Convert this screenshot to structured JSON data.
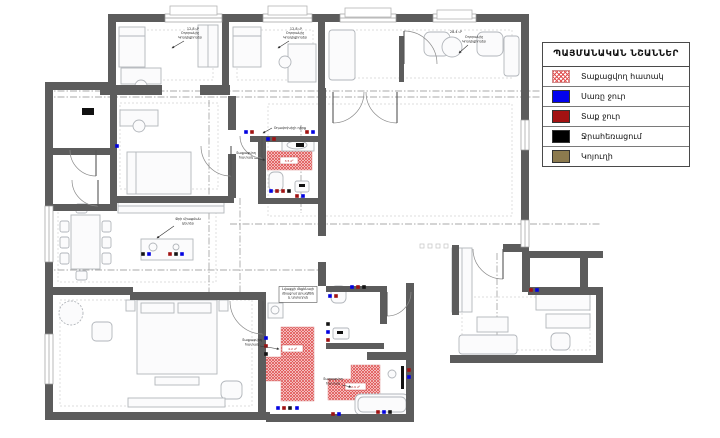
{
  "legend": {
    "title": "ՊԱՅՄԱՆԱԿԱՆ ՆՇԱՆՆԵՐ",
    "items": [
      {
        "swatch": "hatch",
        "label": "Տաքացվող հատակ"
      },
      {
        "swatch": "#0202ee",
        "label": "Սառը ջուր"
      },
      {
        "swatch": "#a31212",
        "label": "Տաք ջուր"
      },
      {
        "swatch": "#000000",
        "label": "Ջրահեռացում"
      },
      {
        "swatch": "#8c7a4e",
        "label": "Կոյուղի"
      }
    ]
  },
  "floorplan": {
    "wall_color": "#5c5c5c",
    "hatch_color": "#e05252",
    "marker_colors": {
      "c": "#0202e0",
      "h": "#a01212",
      "d": "#141414"
    },
    "walls": [
      [
        108,
        14,
        421,
        8
      ],
      [
        108,
        14,
        8,
        74
      ],
      [
        45,
        82,
        71,
        8
      ],
      [
        45,
        82,
        8,
        338
      ],
      [
        45,
        412,
        225,
        8
      ],
      [
        266,
        414,
        148,
        8
      ],
      [
        406,
        283,
        8,
        139
      ],
      [
        367,
        352,
        47,
        8
      ],
      [
        450,
        355,
        153,
        8
      ],
      [
        596,
        287,
        7,
        76
      ],
      [
        528,
        287,
        75,
        8
      ],
      [
        528,
        251,
        75,
        7
      ],
      [
        580,
        251,
        8,
        42
      ],
      [
        521,
        22,
        8,
        225
      ],
      [
        503,
        244,
        26,
        8
      ],
      [
        522,
        252,
        8,
        40
      ],
      [
        318,
        22,
        7,
        66
      ],
      [
        222,
        22,
        7,
        66
      ],
      [
        200,
        85,
        30,
        10
      ],
      [
        100,
        85,
        62,
        10
      ],
      [
        228,
        96,
        8,
        34
      ],
      [
        228,
        154,
        8,
        44
      ],
      [
        250,
        136,
        76,
        6
      ],
      [
        258,
        136,
        8,
        64
      ],
      [
        258,
        198,
        68,
        6
      ],
      [
        318,
        88,
        8,
        118
      ],
      [
        318,
        206,
        8,
        30
      ],
      [
        318,
        262,
        8,
        24
      ],
      [
        110,
        88,
        7,
        123
      ],
      [
        53,
        148,
        63,
        7
      ],
      [
        53,
        204,
        63,
        7
      ],
      [
        116,
        196,
        118,
        7
      ],
      [
        53,
        287,
        80,
        8
      ],
      [
        130,
        292,
        136,
        8
      ],
      [
        258,
        292,
        8,
        128
      ],
      [
        326,
        286,
        56,
        6
      ],
      [
        380,
        286,
        7,
        38
      ],
      [
        326,
        343,
        58,
        6
      ],
      [
        399,
        36,
        5,
        46
      ],
      [
        452,
        245,
        7,
        70
      ]
    ],
    "windows_h": [
      [
        165,
        14,
        57,
        8
      ],
      [
        263,
        14,
        49,
        8
      ],
      [
        340,
        14,
        56,
        8
      ],
      [
        433,
        14,
        43,
        8
      ]
    ],
    "windows_v": [
      [
        45,
        206,
        8,
        56
      ],
      [
        45,
        334,
        8,
        50
      ],
      [
        521,
        120,
        8,
        30
      ],
      [
        521,
        220,
        8,
        27
      ]
    ],
    "sills": [
      [
        170,
        6,
        47,
        9
      ],
      [
        268,
        6,
        39,
        9
      ],
      [
        345,
        8,
        46,
        9
      ],
      [
        437,
        10,
        35,
        9
      ]
    ],
    "dash_rects": [
      [
        123,
        30,
        90,
        50
      ],
      [
        237,
        30,
        76,
        50
      ],
      [
        332,
        30,
        180,
        48
      ],
      [
        268,
        104,
        244,
        112
      ],
      [
        120,
        103,
        98,
        86
      ],
      [
        60,
        300,
        192,
        106
      ],
      [
        462,
        297,
        128,
        53
      ],
      [
        58,
        206,
        158,
        76
      ]
    ],
    "axes": [
      [
        45,
        91,
        540,
        91
      ],
      [
        45,
        97,
        540,
        97
      ],
      [
        230,
        224,
        600,
        224
      ],
      [
        45,
        270,
        320,
        270
      ],
      [
        209,
        100,
        209,
        298
      ],
      [
        301,
        125,
        301,
        213
      ],
      [
        240,
        198,
        240,
        294
      ],
      [
        497,
        253,
        497,
        353
      ]
    ],
    "furniture": [
      [
        "rect",
        119,
        27,
        26,
        40
      ],
      [
        "line",
        119,
        36,
        145,
        36
      ],
      [
        "rect",
        121,
        68,
        40,
        16
      ],
      [
        "circle",
        141,
        86,
        6
      ],
      [
        "rect",
        198,
        25,
        20,
        42
      ],
      [
        "line",
        208,
        25,
        208,
        67
      ],
      [
        "rect",
        233,
        27,
        28,
        40
      ],
      [
        "line",
        233,
        36,
        261,
        36
      ],
      [
        "rect",
        288,
        44,
        28,
        38
      ],
      [
        "circle",
        285,
        62,
        6
      ],
      [
        "rect",
        329,
        30,
        26,
        50,
        3
      ],
      [
        "rect",
        424,
        32,
        26,
        24,
        6
      ],
      [
        "rect",
        477,
        32,
        26,
        24,
        6
      ],
      [
        "circle",
        452,
        47,
        10
      ],
      [
        "rect",
        504,
        36,
        15,
        40,
        3
      ],
      [
        "rect",
        120,
        110,
        38,
        16
      ],
      [
        "circle",
        139,
        126,
        6
      ],
      [
        "rect",
        127,
        152,
        64,
        42
      ],
      [
        "line",
        136,
        152,
        136,
        194
      ],
      [
        "rect",
        118,
        200,
        106,
        13
      ],
      [
        "line",
        118,
        206,
        224,
        206
      ],
      [
        "rect",
        141,
        239,
        52,
        21
      ],
      [
        "circle",
        153,
        247,
        4
      ],
      [
        "circle",
        176,
        247,
        3
      ],
      [
        "rect",
        71,
        215,
        29,
        54
      ],
      [
        "rect",
        60,
        221,
        9,
        11,
        2
      ],
      [
        "rect",
        60,
        237,
        9,
        11,
        2
      ],
      [
        "rect",
        60,
        253,
        9,
        11,
        2
      ],
      [
        "rect",
        102,
        221,
        9,
        11,
        2
      ],
      [
        "rect",
        102,
        237,
        9,
        11,
        2
      ],
      [
        "rect",
        102,
        253,
        9,
        11,
        2
      ],
      [
        "rect",
        76,
        204,
        11,
        9,
        2
      ],
      [
        "rect",
        76,
        271,
        11,
        9,
        2
      ],
      [
        "rect",
        137,
        300,
        80,
        74
      ],
      [
        "rect",
        141,
        303,
        33,
        10
      ],
      [
        "rect",
        178,
        303,
        33,
        10
      ],
      [
        "rect",
        126,
        300,
        9,
        11
      ],
      [
        "rect",
        219,
        300,
        9,
        11
      ],
      [
        "rect",
        155,
        377,
        44,
        8
      ],
      [
        "dcircle",
        71,
        313,
        12
      ],
      [
        "rect",
        92,
        322,
        20,
        19,
        4
      ],
      [
        "rect",
        221,
        381,
        21,
        18,
        5
      ],
      [
        "rect",
        128,
        398,
        97,
        9
      ],
      [
        "rect",
        459,
        335,
        58,
        19,
        3
      ],
      [
        "rect",
        477,
        317,
        31,
        15
      ],
      [
        "rect",
        546,
        314,
        44,
        14
      ],
      [
        "rect",
        551,
        333,
        19,
        17,
        5
      ],
      [
        "rect",
        536,
        293,
        54,
        17
      ],
      [
        "rect",
        452,
        248,
        20,
        64
      ],
      [
        "line",
        462,
        248,
        462,
        312
      ],
      [
        "rect",
        282,
        139,
        32,
        12
      ],
      [
        "ellipse",
        297,
        145,
        10,
        4
      ],
      [
        "rect",
        269,
        172,
        14,
        19,
        5
      ],
      [
        "rect",
        295,
        181,
        14,
        11,
        2
      ],
      [
        "rect",
        331,
        286,
        15,
        17,
        5
      ],
      [
        "rect",
        333,
        328,
        16,
        11,
        2
      ],
      [
        "rect",
        268,
        303,
        15,
        15
      ],
      [
        "circle",
        275,
        310,
        4
      ],
      [
        "rect",
        355,
        394,
        54,
        21,
        6
      ],
      [
        "rect",
        358,
        397,
        48,
        15,
        5
      ],
      [
        "circle",
        392,
        374,
        4
      ]
    ],
    "black_items": [
      [
        82,
        108,
        12,
        7
      ],
      [
        296,
        143,
        8,
        4
      ],
      [
        299,
        184,
        6,
        3
      ],
      [
        337,
        331,
        6,
        3
      ],
      [
        401,
        366,
        3,
        23
      ]
    ],
    "heated_areas": [
      [
        267,
        151,
        45,
        19
      ],
      [
        281,
        327,
        33,
        31
      ],
      [
        263,
        357,
        51,
        24
      ],
      [
        281,
        380,
        33,
        21
      ],
      [
        328,
        379,
        52,
        21
      ],
      [
        351,
        365,
        29,
        15
      ]
    ],
    "area_chips": [
      {
        "x": 280,
        "y": 157,
        "w": 18,
        "h": 7,
        "label": "3.5 մ²"
      },
      {
        "x": 282,
        "y": 345,
        "w": 21,
        "h": 7,
        "label": "4.2 մ²"
      },
      {
        "x": 345,
        "y": 383,
        "w": 21,
        "h": 7,
        "label": "2.9 մ²"
      }
    ],
    "markers": [
      [
        143,
        254,
        "d"
      ],
      [
        149,
        254,
        "c"
      ],
      [
        170,
        254,
        "h"
      ],
      [
        176,
        254,
        "d"
      ],
      [
        182,
        254,
        "c"
      ],
      [
        268,
        139,
        "c"
      ],
      [
        274,
        139,
        "h"
      ],
      [
        307,
        132,
        "h"
      ],
      [
        313,
        132,
        "c"
      ],
      [
        246,
        132,
        "c"
      ],
      [
        252,
        132,
        "h"
      ],
      [
        271,
        191,
        "c"
      ],
      [
        277,
        191,
        "h"
      ],
      [
        283,
        191,
        "h"
      ],
      [
        289,
        191,
        "d"
      ],
      [
        297,
        196,
        "h"
      ],
      [
        303,
        196,
        "c"
      ],
      [
        330,
        296,
        "c"
      ],
      [
        336,
        296,
        "h"
      ],
      [
        328,
        324,
        "d"
      ],
      [
        328,
        332,
        "c"
      ],
      [
        328,
        340,
        "h"
      ],
      [
        266,
        338,
        "c"
      ],
      [
        266,
        346,
        "h"
      ],
      [
        266,
        354,
        "d"
      ],
      [
        278,
        408,
        "c"
      ],
      [
        284,
        408,
        "h"
      ],
      [
        290,
        408,
        "d"
      ],
      [
        297,
        408,
        "c"
      ],
      [
        333,
        414,
        "h"
      ],
      [
        339,
        414,
        "c"
      ],
      [
        378,
        412,
        "h"
      ],
      [
        384,
        412,
        "c"
      ],
      [
        390,
        412,
        "d"
      ],
      [
        352,
        287,
        "c"
      ],
      [
        358,
        287,
        "h"
      ],
      [
        364,
        287,
        "d"
      ],
      [
        531,
        290,
        "h"
      ],
      [
        537,
        290,
        "c"
      ],
      [
        117,
        146,
        "c"
      ],
      [
        409,
        370,
        "h"
      ],
      [
        409,
        377,
        "c"
      ]
    ],
    "deco_squares": [
      [
        420,
        244
      ],
      [
        428,
        244
      ],
      [
        436,
        244
      ],
      [
        444,
        244
      ]
    ],
    "doors": [
      {
        "cx": 333,
        "cy": 92,
        "r": 31,
        "a1": 0,
        "a2": 90,
        "leaf": "a2"
      },
      {
        "cx": 397,
        "cy": 92,
        "r": 31,
        "a1": 90,
        "a2": 180,
        "leaf": "a1"
      },
      {
        "cx": 231,
        "cy": 146,
        "r": 30,
        "a1": 90,
        "a2": 180,
        "leaf": "a1"
      },
      {
        "cx": 96,
        "cy": 150,
        "r": 26,
        "a1": 90,
        "a2": 180,
        "leaf": "a1"
      },
      {
        "cx": 98,
        "cy": 180,
        "r": 26,
        "a1": 90,
        "a2": 180,
        "leaf": "a1"
      },
      {
        "cx": 263,
        "cy": 301,
        "r": 33,
        "a1": 90,
        "a2": 180,
        "leaf": "a1"
      },
      {
        "cx": 262,
        "cy": 136,
        "r": 22,
        "a1": 90,
        "a2": 180,
        "leaf": "a1"
      },
      {
        "cx": 387,
        "cy": 292,
        "r": 24,
        "a1": 0,
        "a2": 90,
        "leaf": "a2"
      },
      {
        "cx": 503,
        "cy": 249,
        "r": 30,
        "a1": 90,
        "a2": 180,
        "leaf": "a1"
      },
      {
        "cx": 404,
        "cy": 64,
        "r": 33,
        "a1": 270,
        "a2": 360,
        "leaf": "a1"
      }
    ],
    "annotations": [
      {
        "x": 190,
        "y": 34,
        "lines": [
          "Օդորակիչ",
          "Կոնդիցիոներ"
        ],
        "leader": [
          184,
          41,
          172,
          48
        ]
      },
      {
        "x": 295,
        "y": 34,
        "lines": [
          "Օդորակիչ",
          "Կոնդիցիոներ"
        ],
        "leader": [
          289,
          41,
          278,
          48
        ]
      },
      {
        "x": 474,
        "y": 38,
        "lines": [
          "Օդորակիչ",
          "Կոնդիցիոներ"
        ],
        "leader": [
          468,
          45,
          459,
          53
        ]
      },
      {
        "x": 290,
        "y": 129,
        "lines": [
          "Օդափոխիչի դիրք"
        ],
        "leader": [
          272,
          128,
          263,
          133
        ]
      },
      {
        "x": 246,
        "y": 154,
        "lines": [
          "Տաքացվող",
          "հատակ"
        ],
        "leader": [
          254,
          158,
          265,
          160
        ]
      },
      {
        "x": 188,
        "y": 220,
        "lines": [
          "Ջրի միացման",
          "կետեր"
        ],
        "leader": [
          174,
          226,
          157,
          238
        ]
      },
      {
        "x": 298,
        "y": 290,
        "lines": [
          "Լվացքի մեքենայի",
          "միացում ջրագծին",
          "և կոյուղուն"
        ],
        "boxed": true
      },
      {
        "x": 252,
        "y": 341,
        "lines": [
          "Տաքացվող",
          "հատակ"
        ],
        "leader": [
          260,
          346,
          279,
          349
        ]
      },
      {
        "x": 333,
        "y": 380,
        "lines": [
          "Տաքացվող",
          "հատակ"
        ],
        "leader": [
          342,
          385,
          351,
          387
        ]
      },
      {
        "x": 193,
        "y": 30,
        "lines": [
          "12.8 մ²"
        ]
      },
      {
        "x": 296,
        "y": 30,
        "lines": [
          "12.8 մ²"
        ]
      },
      {
        "x": 456,
        "y": 33,
        "lines": [
          "28.4 մ²"
        ]
      }
    ]
  }
}
